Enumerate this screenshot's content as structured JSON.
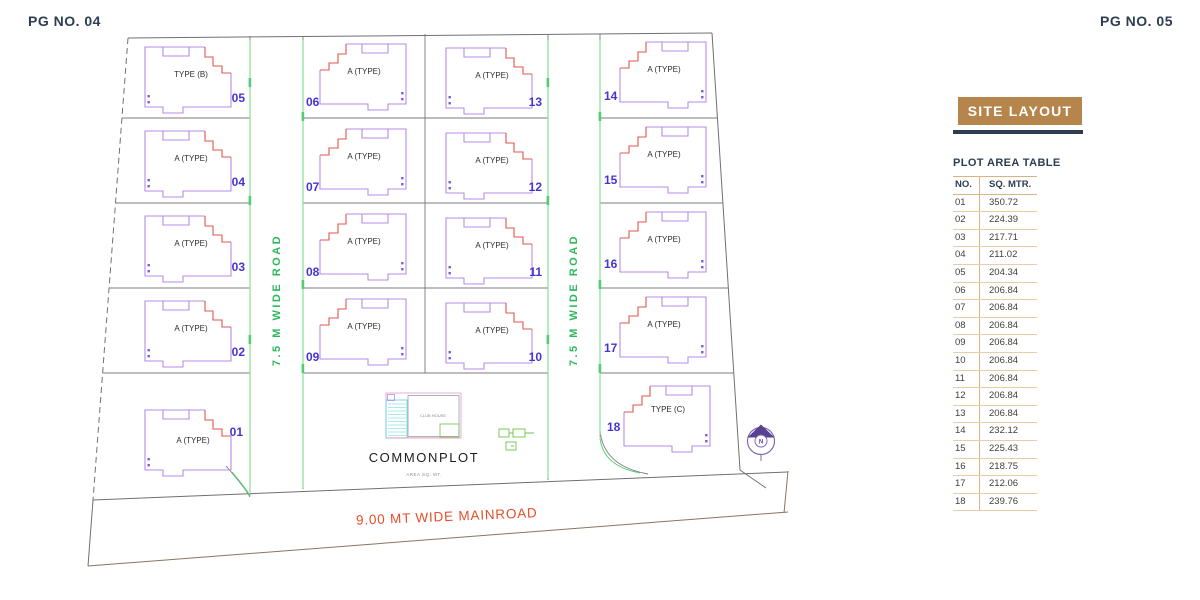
{
  "page": {
    "left_header": "PG NO. 04",
    "right_header": "PG NO. 05"
  },
  "panel": {
    "title": "SITE LAYOUT",
    "table_title": "PLOT AREA TABLE",
    "columns": {
      "no": "NO.",
      "sqm": "SQ. MTR."
    },
    "rows": [
      {
        "no": "01",
        "sqm": "350.72"
      },
      {
        "no": "02",
        "sqm": "224.39"
      },
      {
        "no": "03",
        "sqm": "217.71"
      },
      {
        "no": "04",
        "sqm": "211.02"
      },
      {
        "no": "05",
        "sqm": "204.34"
      },
      {
        "no": "06",
        "sqm": "206.84"
      },
      {
        "no": "07",
        "sqm": "206.84"
      },
      {
        "no": "08",
        "sqm": "206.84"
      },
      {
        "no": "09",
        "sqm": "206.84"
      },
      {
        "no": "10",
        "sqm": "206.84"
      },
      {
        "no": "11",
        "sqm": "206.84"
      },
      {
        "no": "12",
        "sqm": "206.84"
      },
      {
        "no": "13",
        "sqm": "206.84"
      },
      {
        "no": "14",
        "sqm": "232.12"
      },
      {
        "no": "15",
        "sqm": "225.43"
      },
      {
        "no": "16",
        "sqm": "218.75"
      },
      {
        "no": "17",
        "sqm": "212.06"
      },
      {
        "no": "18",
        "sqm": "239.76"
      }
    ]
  },
  "plan": {
    "roads": {
      "left": "7.5 M WIDE ROAD",
      "right": "7.5 M WIDE ROAD",
      "main": "9.00 MT WIDE MAINROAD"
    },
    "commonplot": {
      "label": "COMMONPLOT",
      "caption": "AREA SQ. MT.",
      "clubhouse": "CLUB HOUSE"
    },
    "compass": "N",
    "plots": [
      {
        "no": "01",
        "type": "A (TYPE)"
      },
      {
        "no": "02",
        "type": "A (TYPE)"
      },
      {
        "no": "03",
        "type": "A (TYPE)"
      },
      {
        "no": "04",
        "type": "A (TYPE)"
      },
      {
        "no": "05",
        "type": "TYPE (B)"
      },
      {
        "no": "06",
        "type": "A (TYPE)"
      },
      {
        "no": "07",
        "type": "A (TYPE)"
      },
      {
        "no": "08",
        "type": "A (TYPE)"
      },
      {
        "no": "09",
        "type": "A (TYPE)"
      },
      {
        "no": "10",
        "type": "A (TYPE)"
      },
      {
        "no": "11",
        "type": "A (TYPE)"
      },
      {
        "no": "12",
        "type": "A (TYPE)"
      },
      {
        "no": "13",
        "type": "A (TYPE)"
      },
      {
        "no": "14",
        "type": "A (TYPE)"
      },
      {
        "no": "15",
        "type": "A (TYPE)"
      },
      {
        "no": "16",
        "type": "A (TYPE)"
      },
      {
        "no": "17",
        "type": "A (TYPE)"
      },
      {
        "no": "18",
        "type": "TYPE (C)"
      }
    ]
  },
  "colors": {
    "accent_tan": "#B5854B",
    "navy": "#2E3D54",
    "plot_outline_purple": "#B78BE8",
    "plot_number_blue": "#4534CF",
    "stair_red": "#E2574C",
    "road_green": "#2EB85C",
    "mainroad_orange": "#E4502A"
  }
}
